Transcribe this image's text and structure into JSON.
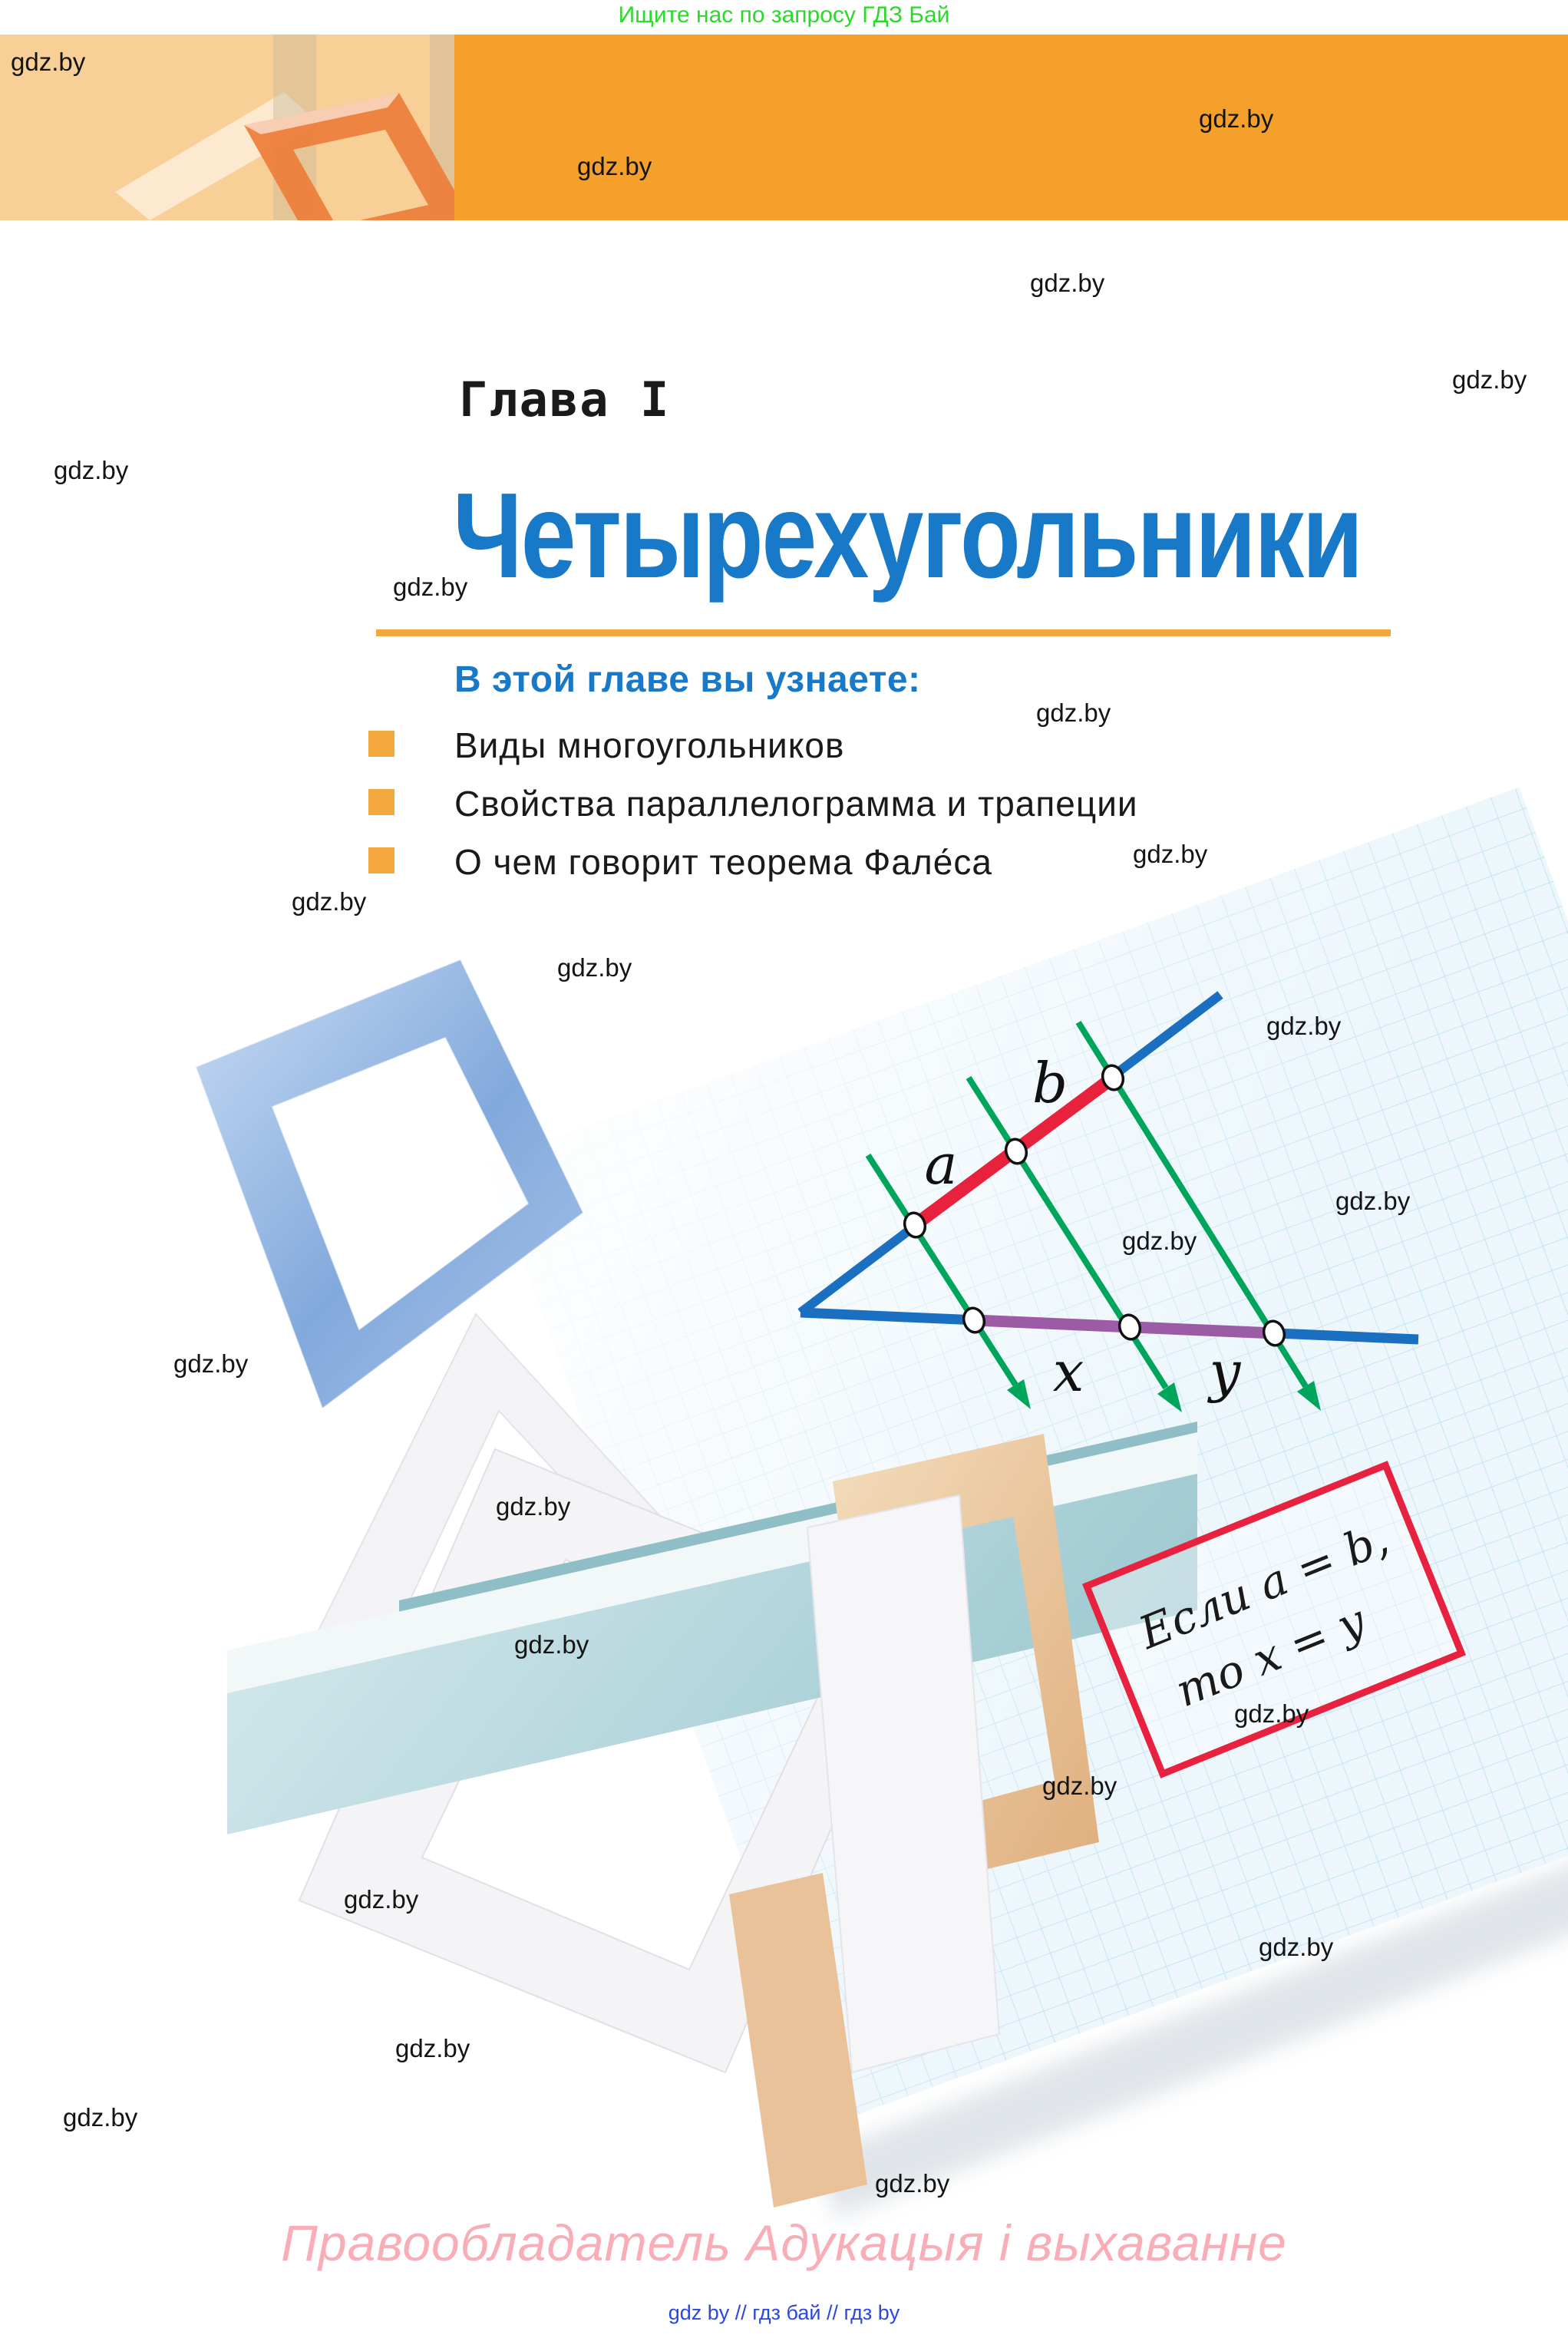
{
  "promo_banner": {
    "text": "Ищите нас по запросу ГДЗ Бай"
  },
  "watermark": {
    "text": "gdz.by"
  },
  "chapter": {
    "label": "Глава I",
    "title": "Четырехугольники"
  },
  "intro": {
    "heading": "В этой главе вы узнаете:",
    "bullets": [
      "Виды многоугольников",
      "Свойства параллелограмма и трапеции",
      "О чем говорит теорема Фале́са"
    ]
  },
  "figure": {
    "label_a": "a",
    "label_b": "b",
    "label_x": "x",
    "label_y": "y",
    "note_line1": "Если a = b,",
    "note_line2": "то x = y"
  },
  "footer": {
    "rights": "Правообладатель Адукацыя і выхаванне",
    "links": "gdz by  //  гдз бай  //  гдз by"
  },
  "colors": {
    "band_orange": "#F5A02B",
    "band_pale": "#F8CF96",
    "title_blue": "#1879C8",
    "accent_orange": "#F2A83D",
    "promo_green": "#2BD92B",
    "footer_pink": "#F8ADB7",
    "links_blue": "#2B48DF",
    "figure_blue": "#1B6FC0",
    "figure_red": "#E8223C",
    "figure_green": "#00A55C",
    "figure_purple": "#9C5CA5",
    "note_box_red": "#E8213F",
    "paper_bg": "#ECF6FB",
    "paper_grid": "#C5E4F2"
  }
}
